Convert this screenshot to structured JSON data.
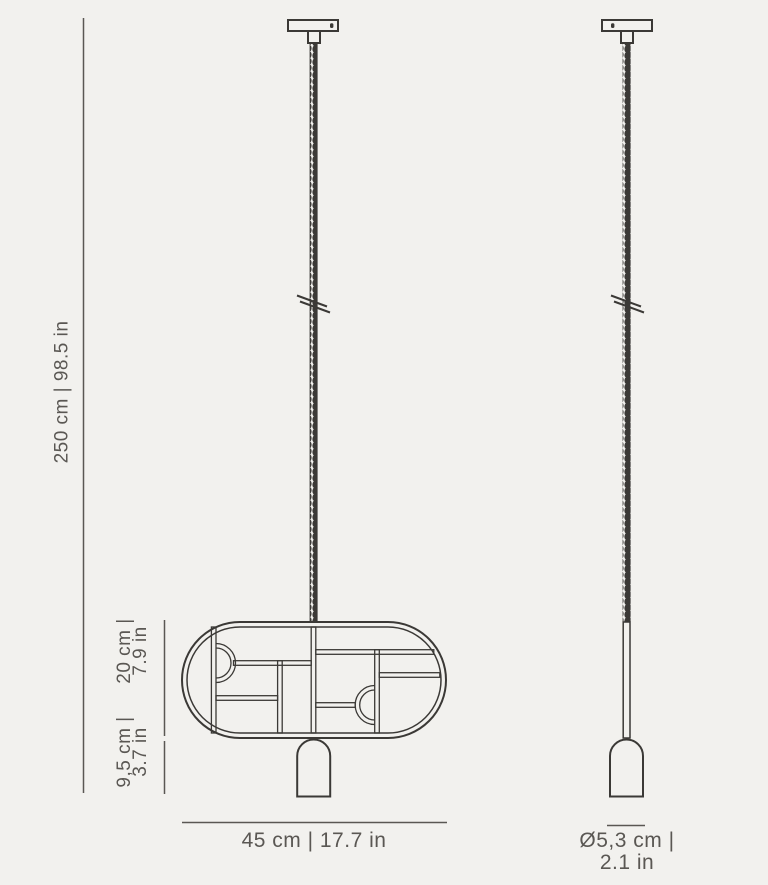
{
  "canvas": {
    "background": "#f2f1ee",
    "drawing_color": "#3b3936",
    "dimension_color": "#5a5753"
  },
  "dimensions": {
    "overall_drop": {
      "label": "250 cm | 98.5 in"
    },
    "frame_height": {
      "line_cm": "20 cm |",
      "line_in": "7.9 in"
    },
    "shade_height": {
      "line_cm": "9,5 cm |",
      "line_in": "3.7 in"
    },
    "frame_width": {
      "label": "45 cm | 17.7 in"
    },
    "shade_diameter": {
      "line_cm": "Ø5,3 cm |",
      "line_in": "2.1 in"
    }
  },
  "icons": {
    "cord_break": "break-mark",
    "canopy_slot": "screw-slot"
  }
}
